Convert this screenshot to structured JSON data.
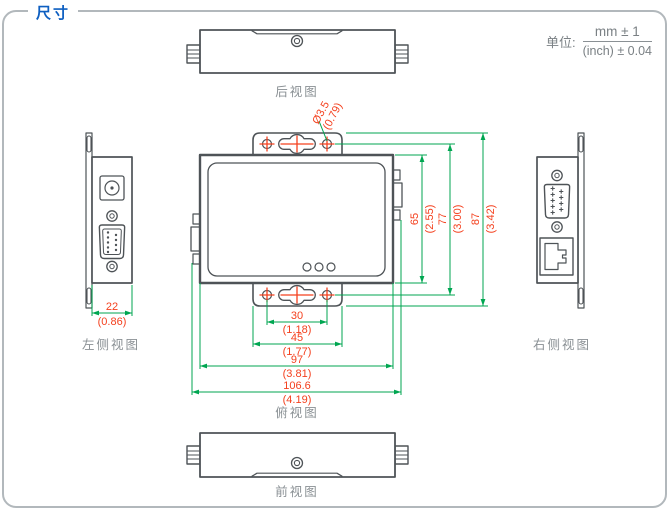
{
  "title": "尺寸",
  "units": {
    "label": "单位:",
    "mm": "mm ± 1",
    "inch": "(inch) ± 0.04"
  },
  "views": {
    "rear": "后视图",
    "left": "左侧视图",
    "top": "俯视图",
    "right": "右侧视图",
    "front": "前视图"
  },
  "dims": {
    "hole": {
      "mm": "Ø3.5",
      "inch": "(0.79)"
    },
    "h65": {
      "mm": "65",
      "inch": "(2.55)"
    },
    "h77": {
      "mm": "77",
      "inch": "(3.00)"
    },
    "h87": {
      "mm": "87",
      "inch": "(3.42)"
    },
    "d22": {
      "mm": "22",
      "inch": "(0.86)"
    },
    "w30": {
      "mm": "30",
      "inch": "(1.18)"
    },
    "w45": {
      "mm": "45",
      "inch": "(1.77)"
    },
    "w97": {
      "mm": "97",
      "inch": "(3.81)"
    },
    "w106": {
      "mm": "106.6",
      "inch": "(4.19)"
    }
  },
  "colors": {
    "dimension_line": "#00a651",
    "dimension_text": "#f4401e",
    "title_blue": "#0e5fc1",
    "outline_gray": "#4e5357",
    "label_gray": "#8a9094",
    "border_gray": "#b2b8bc"
  }
}
